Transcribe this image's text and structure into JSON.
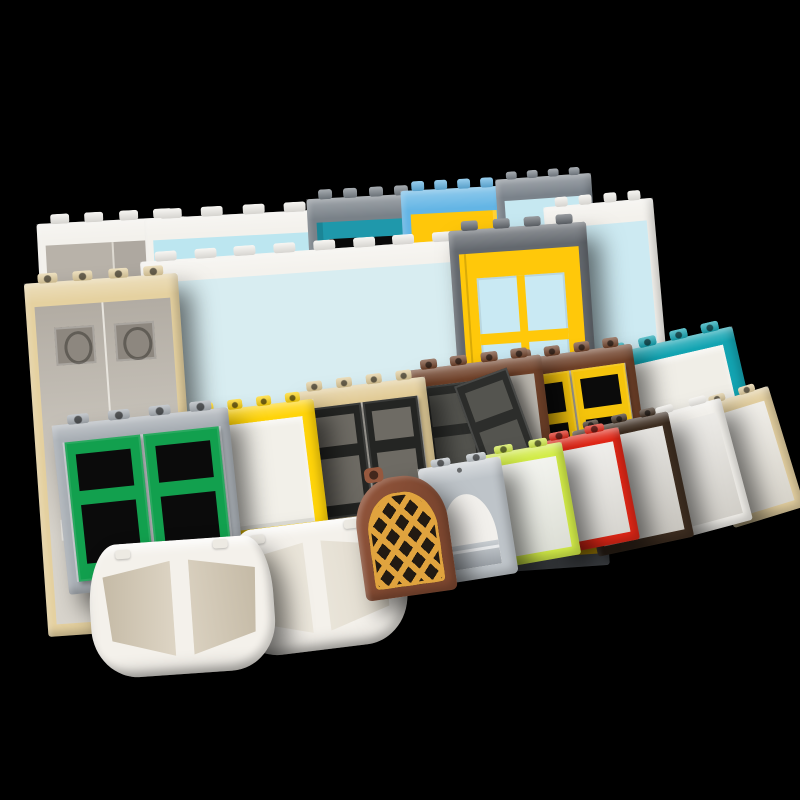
{
  "meta": {
    "background": "#000000",
    "canvas": {
      "width": 800,
      "height": 800
    }
  },
  "scene": {
    "pieces": [
      {
        "id": "door-frame-white-smoke-glass",
        "type": "door_frame",
        "box": [
          42,
          220,
          150,
          215
        ],
        "rot": -3,
        "studs": 4,
        "ins": [
          22,
          8,
          10
        ],
        "door": "smoke_panes",
        "shadow": false,
        "colors": {
          "frame": "#F3F1EC",
          "glass": "#B8B2A9",
          "divider": "#DDD9D1"
        }
      },
      {
        "id": "door-frame-white-blue-doors",
        "type": "door_frame",
        "box": [
          150,
          214,
          178,
          232
        ],
        "rot": -3,
        "studs": 4,
        "ins": [
          22,
          8,
          10
        ],
        "door": "blue_doors",
        "shadow": false,
        "colors": {
          "frame": "#F3F1EC",
          "glass": "#BCE6F0",
          "door": "#49BFE5",
          "divider": "#EAF7FB"
        }
      },
      {
        "id": "door-frame-gray-teal-door",
        "type": "door_frame",
        "box": [
          316,
          196,
          114,
          372
        ],
        "rot": -3,
        "studs": 4,
        "ins": [
          24,
          9,
          12
        ],
        "door": "two_hole",
        "shadow": false,
        "colors": {
          "frame": "#798188",
          "glass": "#9FD3DE",
          "door": "#1F98AB",
          "hole": "#0A0A0A"
        }
      },
      {
        "id": "door-frame-azure-yellow-door",
        "type": "door_frame",
        "box": [
          410,
          188,
          104,
          368
        ],
        "rot": -3,
        "studs": 4,
        "ins": [
          24,
          9,
          12
        ],
        "door": "plain_hole",
        "shadow": false,
        "colors": {
          "frame": "#63B5E5",
          "glass": "#BCE6F0",
          "door": "#FFC70A",
          "hole": "#2A240E"
        }
      },
      {
        "id": "door-frame-gray-aqua-glass",
        "type": "door_frame",
        "box": [
          504,
          176,
          96,
          260
        ],
        "rot": -4,
        "studs": 4,
        "ins": [
          22,
          8,
          10
        ],
        "shadow": false,
        "colors": {
          "frame": "#7A828A",
          "glass": "#C6E8F1"
        }
      },
      {
        "id": "door-frame-white-aqua-glass",
        "type": "door_frame",
        "box": [
          556,
          202,
          110,
          300
        ],
        "rot": -5,
        "studs": 4,
        "ins": [
          22,
          8,
          10
        ],
        "shadow": false,
        "colors": {
          "frame": "#F3F1EC",
          "glass": "#CDEAF2"
        }
      },
      {
        "id": "frame-white-wide-aqua-glass",
        "type": "door_frame",
        "box": [
          150,
          250,
          330,
          298
        ],
        "rot": -4,
        "studs": 8,
        "ins": [
          22,
          9,
          6
        ],
        "shadow": false,
        "colors": {
          "frame": "#F4F2ED",
          "glass": "rgba(205,234,242,0.72)"
        }
      },
      {
        "id": "door-frame-tan-smoke-doors",
        "type": "door_frame",
        "box": [
          36,
          278,
          154,
          354
        ],
        "rot": -4,
        "studs": 4,
        "hollow": true,
        "ins": [
          24,
          9,
          12
        ],
        "door": "smoke_doors",
        "shadow": true,
        "colors": {
          "frame": "#E5D1A0",
          "glassTop": "#B2ACA3",
          "glassBottom": "#D8D4CC",
          "print": "#8D877F",
          "divider": "#E8E5DE"
        }
      },
      {
        "id": "door-frame-gray-yellow-pane-door",
        "type": "door_frame",
        "box": [
          460,
          226,
          138,
          344
        ],
        "rot": -4,
        "studs": 4,
        "ins": [
          24,
          9,
          12
        ],
        "door": "four_pane",
        "shadow": true,
        "colors": {
          "frame": "#63686E",
          "glass": "#CDE9F2",
          "door": "#FFC80A",
          "pane": "#C9E9F3",
          "hole": "#4A3C08"
        }
      },
      {
        "id": "window-frame-teal-white-glass",
        "type": "train_window",
        "box": [
          610,
          340,
          140,
          144
        ],
        "rot": -13,
        "studs": 4,
        "hollow": true,
        "shadow": true,
        "colors": {
          "frame": "#13A4B2",
          "glass": "#F0EEE7"
        }
      },
      {
        "id": "window-frame-brown-yellow-windows",
        "type": "window_double",
        "box": [
          512,
          352,
          130,
          140
        ],
        "rot": -8,
        "studs": 4,
        "hollow": true,
        "shadow": true,
        "colors": {
          "frame": "#6F4129",
          "sash": "#F5C40C",
          "opening": "#0B0B0B",
          "glass": "#C7C3BA"
        }
      },
      {
        "id": "window-frame-brown-black-windows-ajar",
        "type": "window_double",
        "box": [
          416,
          362,
          134,
          144
        ],
        "rot": -7,
        "studs": 4,
        "hollow": true,
        "ajar": true,
        "shadow": true,
        "colors": {
          "frame": "#6F4129",
          "sash": "#2C2D2B",
          "opening": "#54544F",
          "glass": "#B9B5AD"
        }
      },
      {
        "id": "window-frame-tan-black-windows",
        "type": "window_double",
        "box": [
          302,
          384,
          132,
          142
        ],
        "rot": -7,
        "studs": 4,
        "hollow": true,
        "shadow": true,
        "colors": {
          "frame": "#E2CC98",
          "sash": "#242523",
          "opening": "#6E6B64",
          "glass": "#C5C1B9"
        }
      },
      {
        "id": "window-frame-yellow-white-glass",
        "type": "train_window",
        "box": [
          194,
          406,
          128,
          136
        ],
        "rot": -7,
        "studs": 4,
        "hollow": true,
        "shadow": true,
        "colors": {
          "frame": "#FFD40A",
          "glass": "#F2F0E9"
        }
      },
      {
        "id": "window-frame-gray-green-windows",
        "type": "window_double",
        "box": [
          60,
          416,
          177,
          170
        ],
        "rot": -6,
        "studs": 4,
        "hollow": true,
        "shadow": true,
        "colors": {
          "frame": "#A9AFB5",
          "sash": "#12A04E",
          "opening": "#0B0B0B",
          "glass": "#C9CDD1"
        }
      },
      {
        "id": "bow-window-right",
        "type": "bow_window",
        "box": [
          228,
          522,
          178,
          128
        ],
        "rot": -7,
        "shadow": true,
        "colors": {
          "body": "#F4F1EB",
          "glassA": "#EFEBE1",
          "glassB": "#DDD6C8",
          "stud": "#EDEAE3"
        }
      },
      {
        "id": "bow-window-left",
        "type": "bow_window",
        "box": [
          90,
          540,
          184,
          134
        ],
        "rot": -4,
        "shadow": true,
        "colors": {
          "body": "#F4F1EB",
          "glassA": "#E6DECF",
          "glassB": "#BFB49F",
          "stud": "#EDEAE3"
        }
      },
      {
        "id": "window-tan-tall",
        "type": "simple_window",
        "box": [
          714,
          394,
          74,
          126
        ],
        "rot": -17,
        "studs": 2,
        "hollow": true,
        "shadow": true,
        "colors": {
          "frame": "#E3CFA0",
          "glass": "#E9E5DB"
        }
      },
      {
        "id": "window-white",
        "type": "simple_window",
        "box": [
          658,
          406,
          80,
          126
        ],
        "rot": -15,
        "studs": 2,
        "shadow": true,
        "colors": {
          "frame": "#F2F0EB",
          "glass": "#E2DFD8"
        }
      },
      {
        "id": "window-dark-brown",
        "type": "simple_window",
        "box": [
          584,
          420,
          98,
          128
        ],
        "rot": -12,
        "studs": 3,
        "hollow": true,
        "shadow": true,
        "colors": {
          "frame": "#3E2E21",
          "glass": "#D8D5CE"
        }
      },
      {
        "id": "window-red",
        "type": "simple_window",
        "box": [
          546,
          434,
          84,
          114
        ],
        "rot": -11,
        "studs": 2,
        "hollow": true,
        "shadow": true,
        "colors": {
          "frame": "#E02717",
          "glass": "#E8E6E0"
        }
      },
      {
        "id": "window-lime",
        "type": "simple_window",
        "box": [
          490,
          448,
          82,
          114
        ],
        "rot": -10,
        "studs": 2,
        "hollow": true,
        "shadow": true,
        "colors": {
          "frame": "#D3EC49",
          "glass": "#EEF0E6"
        }
      },
      {
        "id": "window-gray-arch",
        "type": "arch_window",
        "box": [
          426,
          462,
          84,
          118
        ],
        "rot": -9,
        "studs": 2,
        "hollow": true,
        "shadow": true,
        "colors": {
          "frame": "#BEC4C9",
          "fill": "#F2F0EC",
          "sill": "#9AA0A6",
          "sillHi": "#C9CED2"
        }
      },
      {
        "id": "window-brown-arch-gold-lattice",
        "type": "arch_lattice",
        "box": [
          358,
          476,
          92,
          120
        ],
        "rot": -8,
        "shadow": true,
        "colors": {
          "body": "#7D4730",
          "bodyHi": "#96583E",
          "lattice": "#E0A33E",
          "bg": "#221A12"
        }
      }
    ]
  }
}
